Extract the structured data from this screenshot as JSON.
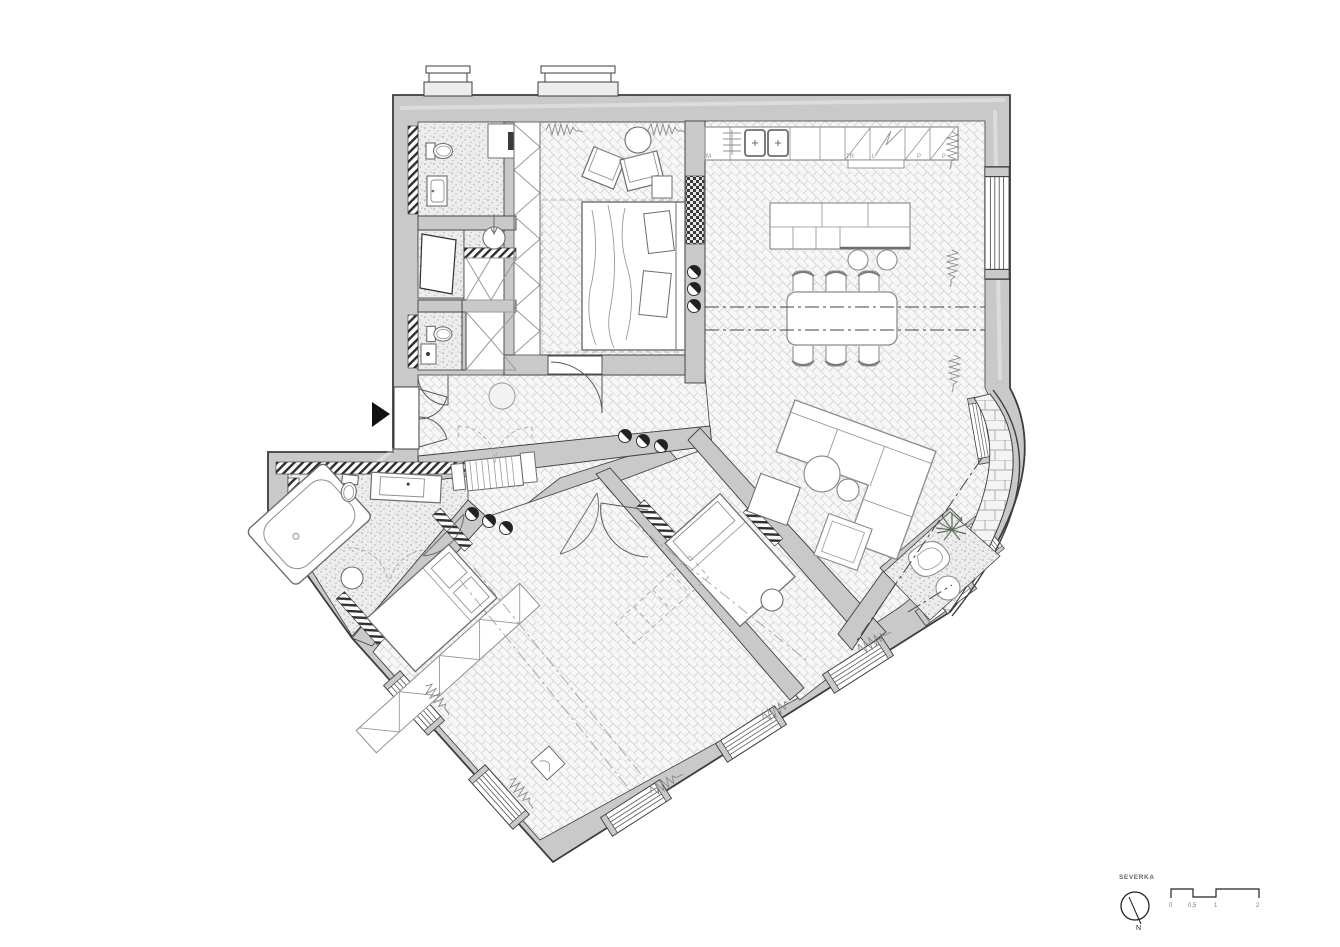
{
  "annotations": {
    "north_label": "SEVERKA",
    "north_letter": "N",
    "scale_ticks": {
      "t0": "0",
      "t05": "0,5",
      "t1": "1",
      "t2": "2"
    },
    "kitchen_appliances": {
      "dishwasher": "M",
      "oven": "TR",
      "fridge": "L",
      "pantry1": "P",
      "pantry2": "P"
    }
  },
  "colors": {
    "background": "#ffffff",
    "wall_fill": "#c9c9c9",
    "wall_line": "#3d3d3d",
    "furniture_line": "#8f8f8f",
    "floor_pattern_line": "#d7d7d7",
    "speckle_floor": "#ededed",
    "dark_hatch": "#2f2f2f",
    "centerline": "#555555"
  }
}
